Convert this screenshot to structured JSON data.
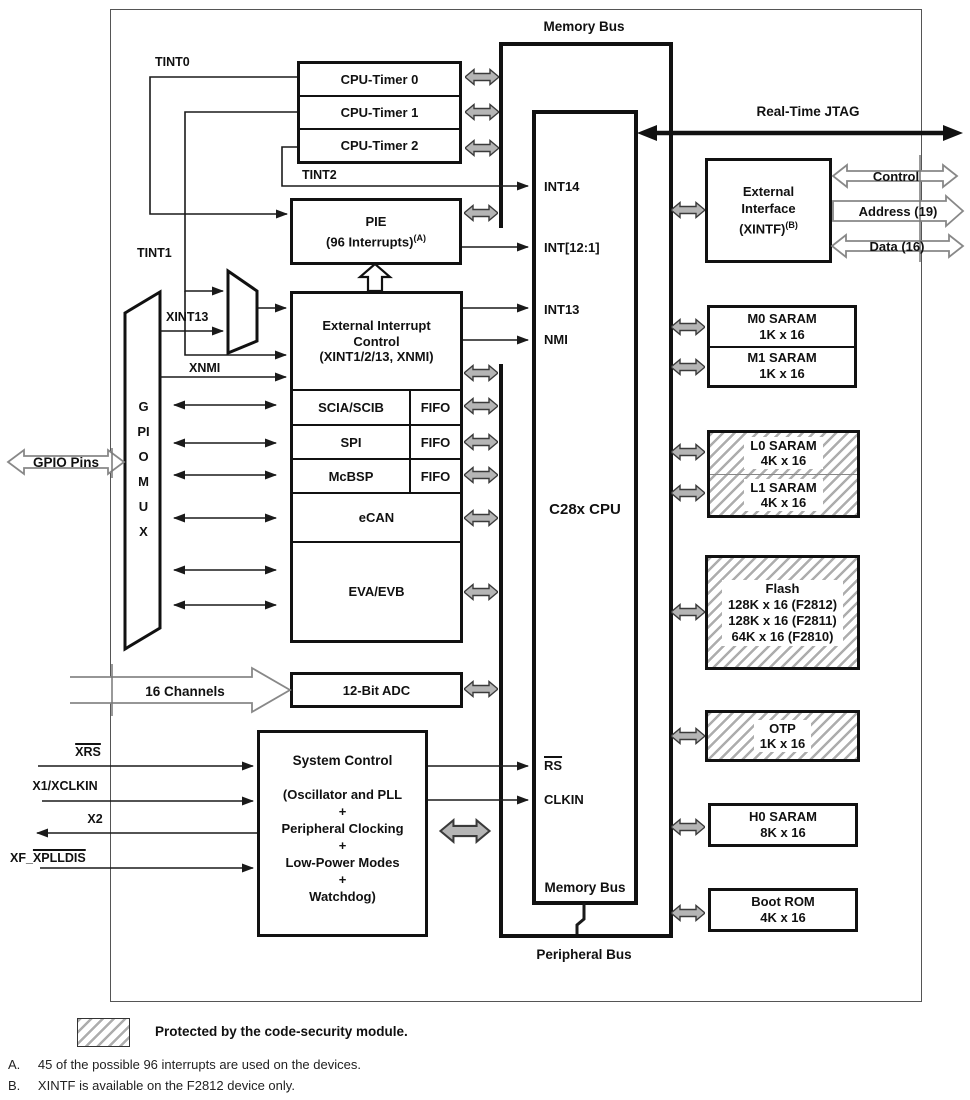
{
  "buses": {
    "memory_bus_top": "Memory Bus",
    "peripheral_bus": "Peripheral Bus",
    "jtag": "Real-Time JTAG"
  },
  "timers": {
    "t0": "CPU-Timer 0",
    "t1": "CPU-Timer 1",
    "t2": "CPU-Timer 2"
  },
  "pie": {
    "title": "PIE",
    "subtitle": "(96 Interrupts)",
    "sup": "(A)"
  },
  "extint": {
    "l1": "External Interrupt",
    "l2": "Control",
    "l3": "(XINT1/2/13, XNMI)"
  },
  "periph": {
    "scia": "SCIA/SCIB",
    "spi": "SPI",
    "mcbsp": "McBSP",
    "fifo": "FIFO",
    "ecan": "eCAN",
    "eva": "EVA/EVB"
  },
  "adc": {
    "label": "12-Bit ADC",
    "channels": "16 Channels"
  },
  "sysctrl": {
    "title": "System Control",
    "l1": "(Oscillator and PLL",
    "plus": "+",
    "l2": "Peripheral Clocking",
    "l3": "Low-Power Modes",
    "l4": "Watchdog)"
  },
  "cpu": {
    "int14": "INT14",
    "int12": "INT[12:1]",
    "int13": "INT13",
    "nmi": "NMI",
    "name": "C28x CPU",
    "rs": "RS",
    "clkin": "CLKIN",
    "membus": "Memory Bus"
  },
  "xintf": {
    "l1": "External",
    "l2": "Interface",
    "l3": "(XINTF)",
    "sup": "(B)",
    "control": "Control",
    "address": "Address (19)",
    "data": "Data (16)"
  },
  "mem": {
    "m0": {
      "name": "M0 SARAM",
      "size": "1K x 16"
    },
    "m1": {
      "name": "M1 SARAM",
      "size": "1K x 16"
    },
    "l0": {
      "name": "L0 SARAM",
      "size": "4K x 16"
    },
    "l1": {
      "name": "L1 SARAM",
      "size": "4K x 16"
    },
    "flash": {
      "name": "Flash",
      "s1": "128K x 16 (F2812)",
      "s2": "128K x 16 (F2811)",
      "s3": "64K x 16 (F2810)"
    },
    "otp": {
      "name": "OTP",
      "size": "1K x 16"
    },
    "h0": {
      "name": "H0 SARAM",
      "size": "8K x 16"
    },
    "boot": {
      "name": "Boot ROM",
      "size": "4K x 16"
    }
  },
  "signals": {
    "tint0": "TINT0",
    "tint1": "TINT1",
    "tint2": "TINT2",
    "xint13": "XINT13",
    "xnmi": "XNMI",
    "gpio_pins": "GPIO Pins",
    "gpio_mux": "GPIO MUX",
    "xrs": "XRS",
    "x1": "X1/XCLKIN",
    "x2": "X2",
    "xf_prefix": "XF_",
    "xf_overline": "XPLLDIS"
  },
  "legend": {
    "text": "Protected by the code-security module."
  },
  "notes": [
    {
      "id": "A.",
      "text": "45 of the possible 96 interrupts are used on the devices."
    },
    {
      "id": "B.",
      "text": "XINTF is available on the F2812 device only."
    }
  ]
}
